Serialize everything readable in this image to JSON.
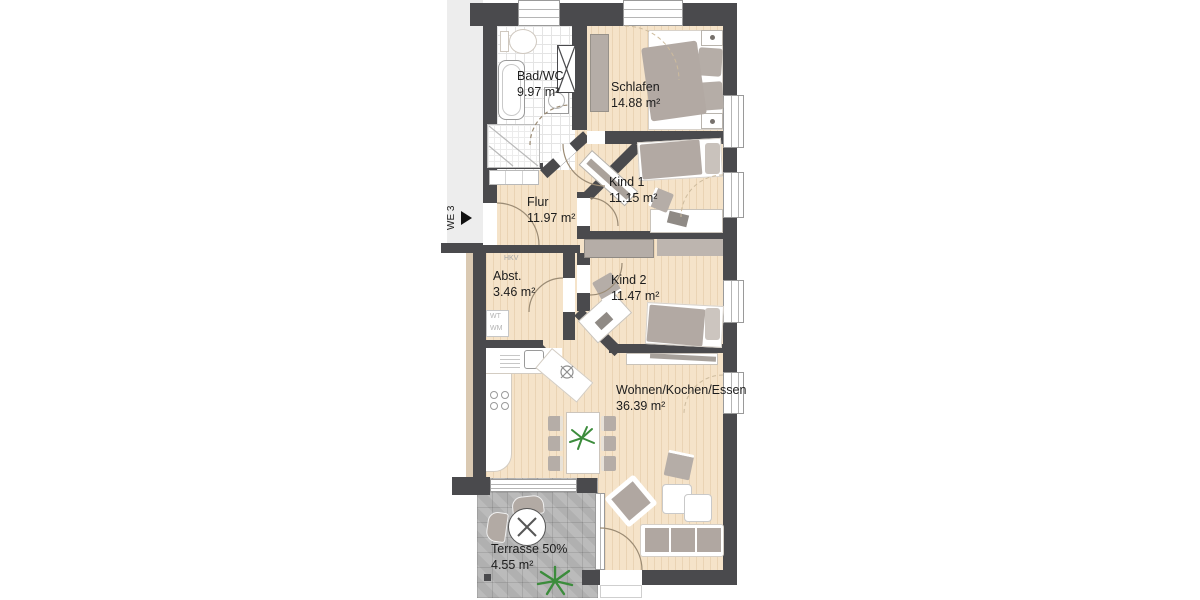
{
  "plan": {
    "unit_label": "WE 3",
    "rooms": [
      {
        "id": "bad",
        "name": "Bad/WC",
        "area": "9.97 m²"
      },
      {
        "id": "schlafen",
        "name": "Schlafen",
        "area": "14.88 m²"
      },
      {
        "id": "kind1",
        "name": "Kind 1",
        "area": "11.15 m²"
      },
      {
        "id": "flur",
        "name": "Flur",
        "area": "11.97 m²"
      },
      {
        "id": "abst",
        "name": "Abst.",
        "area": "3.46 m²"
      },
      {
        "id": "kind2",
        "name": "Kind 2",
        "area": "11.47 m²"
      },
      {
        "id": "wohnen",
        "name": "Wohnen/Kochen/Essen",
        "area": "36.39 m²"
      },
      {
        "id": "terrasse",
        "name": "Terrasse 50%",
        "area": "4.55 m²"
      }
    ],
    "annotations": {
      "hkv": "HKV",
      "wt": "WT",
      "wm": "WM"
    },
    "colors": {
      "wall": "#4a4a4d",
      "wood": "#f5e3c9",
      "tile_line": "#e4e4e4",
      "furniture": "#b5ada7",
      "terrace": "#b7b7b7",
      "corridor": "#ededed",
      "plant_green": "#3c8c3c",
      "arc": "#9b8b74"
    }
  }
}
